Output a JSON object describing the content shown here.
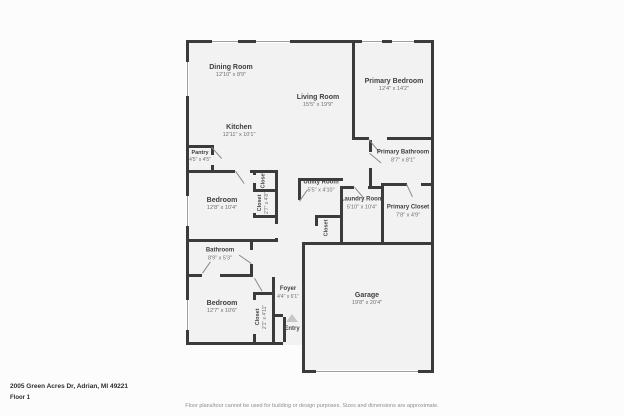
{
  "meta": {
    "address": "2005 Green Acres Dr, Adrian, MI 49221",
    "floor_label": "Floor 1",
    "disclaimer": "Floor plans/tour cannot be used for building or design purposes. Sizes and dimensions are approximate."
  },
  "entry": {
    "label": "Entry",
    "arrow_icon": "up-triangle"
  },
  "colors": {
    "wall": "#3b3b3b",
    "floor_fill": "#f2f2f2",
    "window_line": "#9e9e9e",
    "label_text": "#3f3f3f",
    "dims_text": "#6f6f6f"
  },
  "rooms": [
    {
      "name": "Dining Room",
      "dims": "12'10\" x 8'9\""
    },
    {
      "name": "Living Room",
      "dims": "15'5\" x 19'9\""
    },
    {
      "name": "Primary Bedroom",
      "dims": "12'4\" x 14'2\""
    },
    {
      "name": "Kitchen",
      "dims": "12'11\" x 10'1\""
    },
    {
      "name": "Pantry",
      "dims": "4'5\" x 4'5\""
    },
    {
      "name": "Primary Bathroom",
      "dims": "8'7\" x 8'1\""
    },
    {
      "name": "Primary Closet",
      "dims": "7'8\" x 4'9\""
    },
    {
      "name": "Laundry Room",
      "dims": "5'10\" x 10'4\""
    },
    {
      "name": "Utility Room",
      "dims": "5'5\" x 4'10\""
    },
    {
      "name": "Bedroom",
      "dims": "12'8\" x 10'4\""
    },
    {
      "name": "Closet",
      "dims": ""
    },
    {
      "name": "Closet",
      "dims": "2'7\" x 4'8\""
    },
    {
      "name": "Closet",
      "dims": ""
    },
    {
      "name": "Bathroom",
      "dims": "8'9\" x 5'3\""
    },
    {
      "name": "Bedroom",
      "dims": "12'7\" x 10'6\""
    },
    {
      "name": "Closet",
      "dims": "2'1\" x 4'11\""
    },
    {
      "name": "Foyer",
      "dims": "4'4\" x 6'1\""
    },
    {
      "name": "Garage",
      "dims": "19'8\" x 20'4\""
    }
  ]
}
